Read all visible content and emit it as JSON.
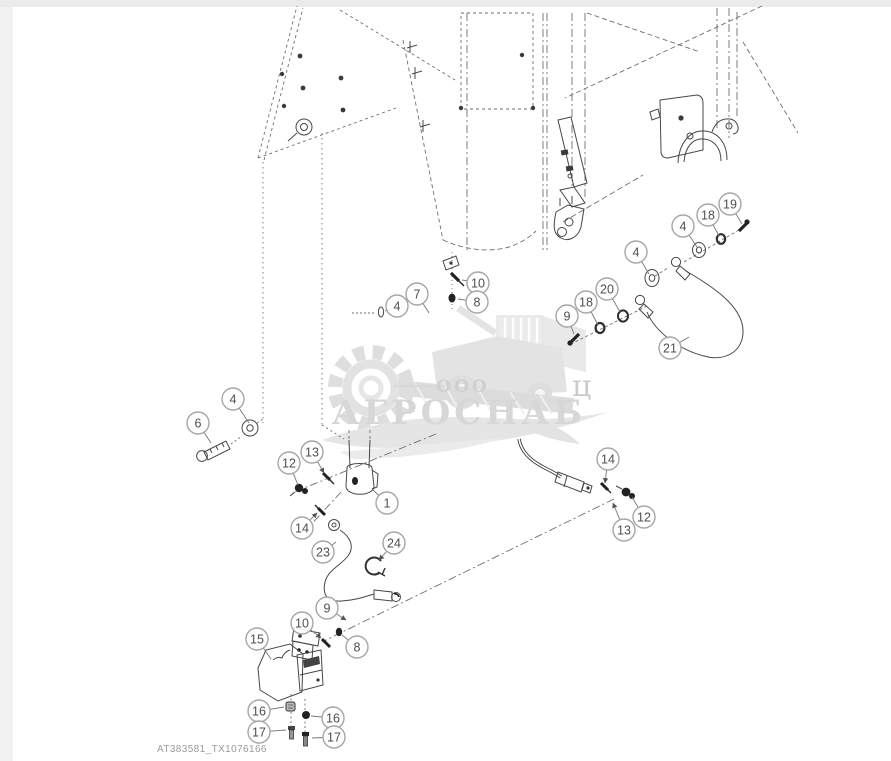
{
  "page": {
    "figure_label": "AT383581_TX1076166",
    "background": "#ffffff",
    "line_color": "#474747",
    "callout_ring_color": "#a6a6a6",
    "callout_text_color": "#4f4f4f",
    "leader_color": "#777777"
  },
  "watermark": {
    "org_form": "ООО",
    "name": "АГРОСНАБ",
    "stray_letter": "ц",
    "color_big": "#d7d7d7",
    "color_small": "#cfcfcf"
  },
  "part_numbers_visible": [
    1,
    4,
    6,
    7,
    8,
    9,
    10,
    12,
    13,
    14,
    15,
    16,
    17,
    18,
    19,
    20,
    21,
    23,
    24
  ],
  "callouts": [
    {
      "n": "10",
      "x": 478,
      "y": 283,
      "tx": 462,
      "ty": 280,
      "arrow": false
    },
    {
      "n": "8",
      "x": 477,
      "y": 302,
      "tx": 458,
      "ty": 299,
      "arrow": false
    },
    {
      "n": "7",
      "x": 417,
      "y": 294,
      "tx": 429,
      "ty": 313,
      "arrow": false
    },
    {
      "n": "4",
      "x": 397,
      "y": 306,
      "tx": 385,
      "ty": 311,
      "arrow": false
    },
    {
      "n": "4",
      "x": 233,
      "y": 399,
      "tx": 249,
      "ty": 423,
      "arrow": false
    },
    {
      "n": "6",
      "x": 198,
      "y": 423,
      "tx": 211,
      "ty": 443,
      "arrow": false
    },
    {
      "n": "19",
      "x": 730,
      "y": 204,
      "tx": 742,
      "ty": 224,
      "arrow": false
    },
    {
      "n": "18",
      "x": 708,
      "y": 215,
      "tx": 719,
      "ty": 236,
      "arrow": false
    },
    {
      "n": "4",
      "x": 683,
      "y": 226,
      "tx": 697,
      "ty": 247,
      "arrow": false
    },
    {
      "n": "4",
      "x": 636,
      "y": 252,
      "tx": 649,
      "ty": 274,
      "arrow": false
    },
    {
      "n": "20",
      "x": 607,
      "y": 289,
      "tx": 620,
      "ty": 312,
      "arrow": false
    },
    {
      "n": "18",
      "x": 586,
      "y": 302,
      "tx": 598,
      "ty": 325,
      "arrow": false
    },
    {
      "n": "9",
      "x": 567,
      "y": 316,
      "tx": 574,
      "ty": 334,
      "arrow": false
    },
    {
      "n": "21",
      "x": 670,
      "y": 348,
      "tx": 689,
      "ty": 337,
      "arrow": false
    },
    {
      "n": "12",
      "x": 289,
      "y": 463,
      "tx": 298,
      "ty": 485,
      "arrow": false
    },
    {
      "n": "13",
      "x": 312,
      "y": 452,
      "tx": 324,
      "ty": 473,
      "arrow": true
    },
    {
      "n": "1",
      "x": 387,
      "y": 503,
      "tx": 373,
      "ty": 490,
      "arrow": false
    },
    {
      "n": "14",
      "x": 302,
      "y": 528,
      "tx": 317,
      "ty": 513,
      "arrow": true
    },
    {
      "n": "23",
      "x": 323,
      "y": 552,
      "tx": 336,
      "ty": 542,
      "arrow": false
    },
    {
      "n": "24",
      "x": 394,
      "y": 543,
      "tx": 379,
      "ty": 560,
      "arrow": true
    },
    {
      "n": "14",
      "x": 608,
      "y": 459,
      "tx": 605,
      "ty": 483,
      "arrow": true
    },
    {
      "n": "12",
      "x": 644,
      "y": 517,
      "tx": 632,
      "ty": 497,
      "arrow": false
    },
    {
      "n": "13",
      "x": 624,
      "y": 530,
      "tx": 613,
      "ty": 503,
      "arrow": true
    },
    {
      "n": "9",
      "x": 327,
      "y": 608,
      "tx": 346,
      "ty": 620,
      "arrow": true
    },
    {
      "n": "10",
      "x": 302,
      "y": 623,
      "tx": 321,
      "ty": 638,
      "arrow": true
    },
    {
      "n": "8",
      "x": 357,
      "y": 647,
      "tx": 342,
      "ty": 635,
      "arrow": false
    },
    {
      "n": "15",
      "x": 257,
      "y": 639,
      "tx": 271,
      "ty": 659,
      "arrow": false
    },
    {
      "n": "16",
      "x": 259,
      "y": 711,
      "tx": 284,
      "ty": 707,
      "arrow": false
    },
    {
      "n": "16",
      "x": 333,
      "y": 718,
      "tx": 311,
      "ty": 716,
      "arrow": false
    },
    {
      "n": "17",
      "x": 259,
      "y": 732,
      "tx": 286,
      "ty": 730,
      "arrow": false
    },
    {
      "n": "17",
      "x": 334,
      "y": 737,
      "tx": 312,
      "ty": 738,
      "arrow": false
    }
  ]
}
